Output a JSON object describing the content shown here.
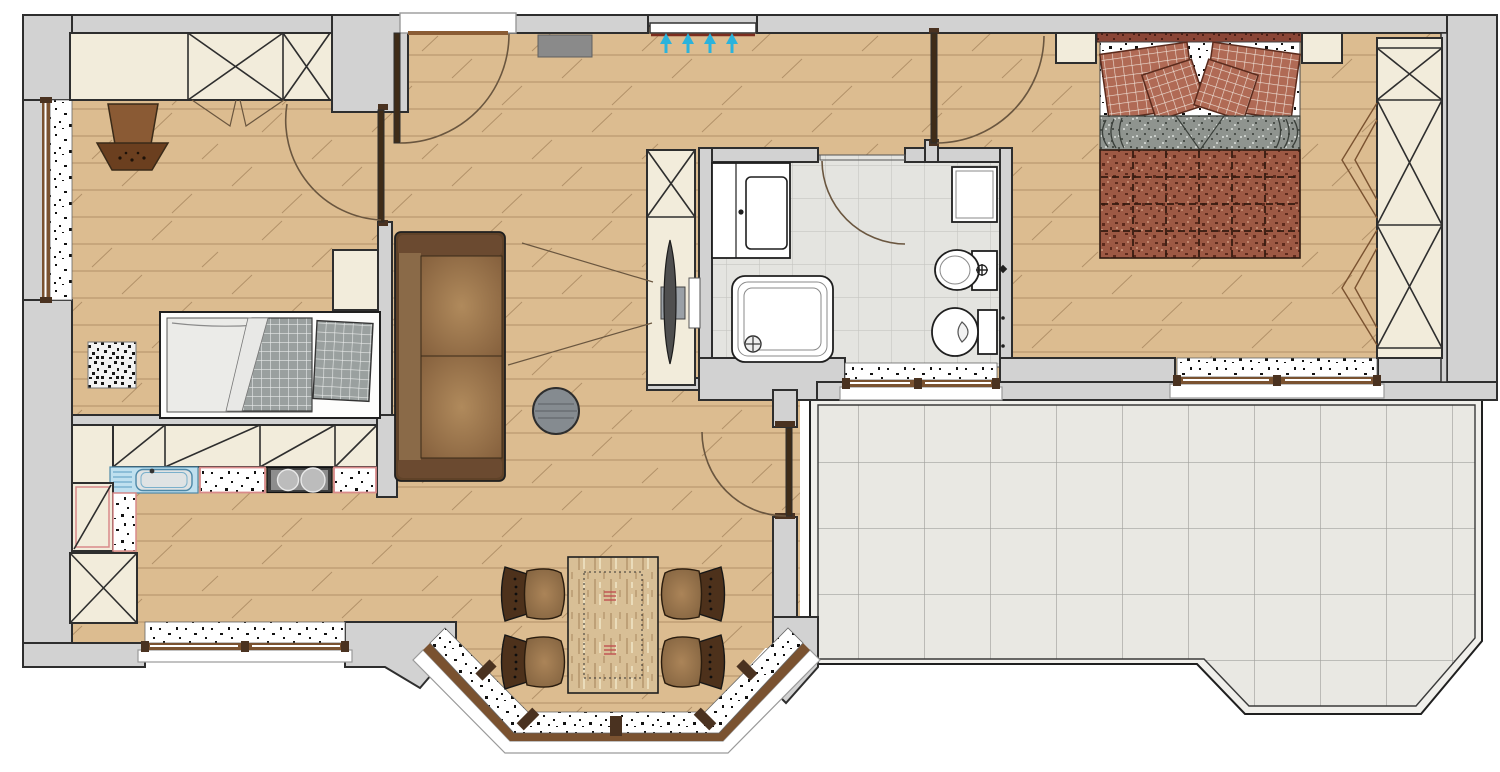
{
  "plan": {
    "kind": "apartment-floor-plan",
    "rooms": [
      {
        "id": "children-room",
        "furniture": [
          "wardrobe-x",
          "potted-plant",
          "rug",
          "single-bed",
          "wall-shelf"
        ]
      },
      {
        "id": "entry-hall",
        "furniture": [
          "entrance-door",
          "doormat",
          "radiator-with-airflow-arrows"
        ]
      },
      {
        "id": "kitchen",
        "furniture": [
          "upper-cabinet-row",
          "sink-unit",
          "cooktop",
          "worktop",
          "fridge-cabinet",
          "tall-cabinet-x"
        ]
      },
      {
        "id": "living-dining",
        "furniture": [
          "sofa",
          "side-table",
          "tv-cabinet",
          "tv-panel",
          "dining-table",
          "chair",
          "chair",
          "chair",
          "chair",
          "terrace-door",
          "bay-window"
        ]
      },
      {
        "id": "bathroom",
        "furniture": [
          "washing-machine",
          "shower",
          "washbasin",
          "bidet",
          "toilet"
        ]
      },
      {
        "id": "master-bedroom",
        "furniture": [
          "double-bed",
          "nightstand-left",
          "nightstand-right",
          "wardrobe-folding-doors"
        ]
      },
      {
        "id": "terrace",
        "furniture": [
          "tiled-floor",
          "railing"
        ]
      }
    ],
    "window_count": 5,
    "door_arc_count": 5,
    "airflow_arrow_count": 4
  },
  "colors": {
    "wall": "#d2d2d2",
    "line": "#2e2e2e",
    "wood": "#dcbc90",
    "woodLine": "#ab8a61",
    "cream": "#f2ecdb",
    "doorArc": "#6a563f",
    "leaf": "#3f2c18",
    "accentArrow": "#2ab3dc",
    "radiatorLine": "#7c2d1e",
    "sofaFrame": "#5f4228",
    "sofaBack": "#8a6a48",
    "sofaArm": "#6b4a30",
    "chairBack": "#4d311b",
    "tableWood": "#d8bf96",
    "quilt": "#9d5944",
    "quiltSeam": "#33190e",
    "pillowRed": "#b06a55",
    "blanketGray": "#8f948f",
    "checkGray": "#9aa09f",
    "sinkBlue": "#bfe0ef",
    "sinkBlueLine": "#5a9cc0",
    "stoveDark": "#3f3f3f",
    "stoveMid": "#8d8d8d",
    "burner": "#bcbcbc",
    "counterEdge": "#d98a8a",
    "matGray": "#8a8a8a",
    "sideTable": "#858b90",
    "frameBrown": "#7a5230",
    "postBrown": "#4a3220",
    "rugBase": "#f2f2f2",
    "rugDot": "#151515",
    "headboard": "#8a4536",
    "tileBath": "#e4e4e0",
    "tileBathLine": "#c6c6c2",
    "tileTerr": "#e9e8e3",
    "tileTerrLine": "#a2a29e"
  }
}
